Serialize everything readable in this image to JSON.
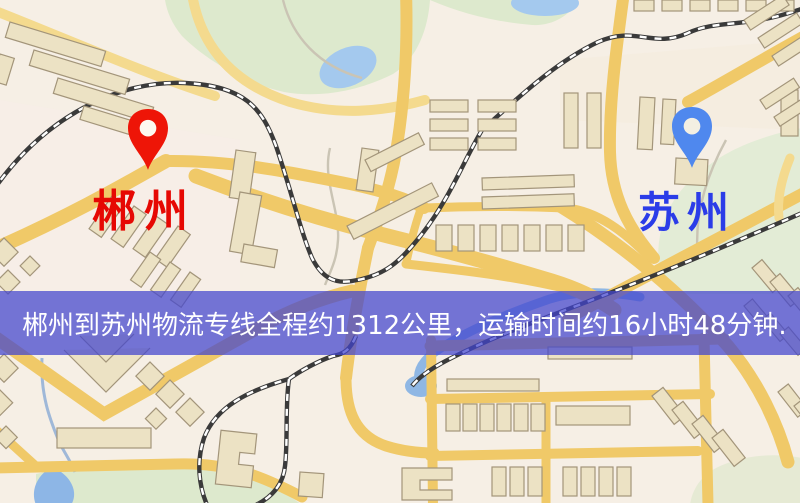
{
  "page": {
    "width_px": 800,
    "height_px": 503,
    "kind": "logistics-route-map"
  },
  "markers": [
    {
      "id": "origin",
      "city_label": "郴州",
      "pin_color": "#ee1507",
      "label_color": "#e60803"
    },
    {
      "id": "destination",
      "city_label": "苏州",
      "pin_color": "#4f88ee",
      "label_color": "#2b3ce8"
    }
  ],
  "route_banner": {
    "text": "郴州到苏州物流专线全程约1312公里，运输时间约16小时48分钟.",
    "distance_km": "1312",
    "duration": "16小时48分钟",
    "background_color": "rgba(66,68,205,0.73)",
    "text_color": "#ffffff"
  },
  "map_palette": {
    "background": "#f6efe5",
    "road_major": "#f0c968",
    "road_minor": "#f4da8e",
    "railway": "#3a3a3a",
    "park": "#dde9cd",
    "water": "#a4c9ee",
    "building_fill": "#ece2c4",
    "building_stroke": "#a3957a"
  }
}
